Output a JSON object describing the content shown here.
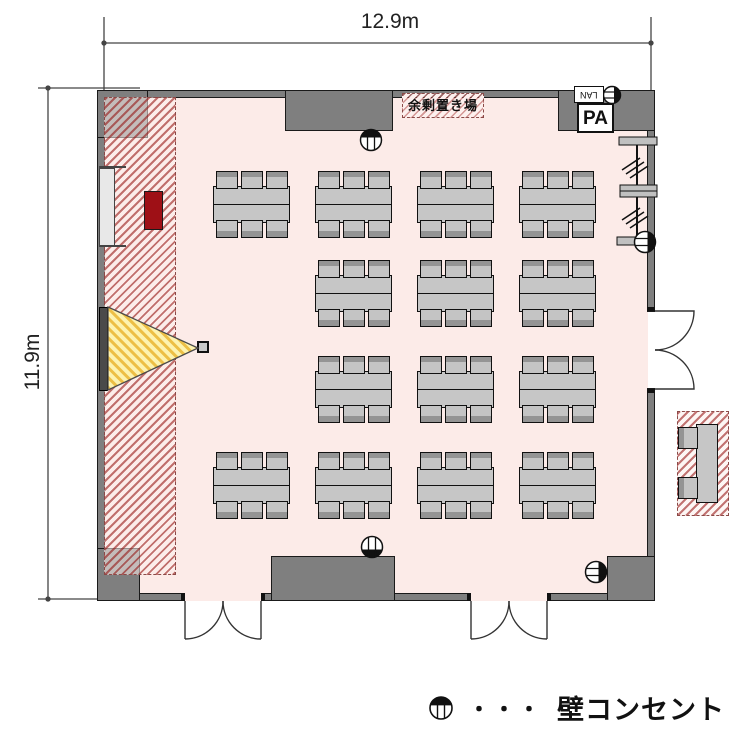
{
  "title": "seminar-room-floor-plan",
  "dimensions": {
    "width": "12.9m",
    "height": "11.9m"
  },
  "stage": {
    "storage_label": "余剰置き場",
    "pa_label": "PA",
    "lan_label": "LAN"
  },
  "legend": {
    "symbol": "wall-outlet",
    "dots": "・・・",
    "label": "壁コンセント"
  },
  "furniture": {
    "table_count": 14,
    "chairs_per_table": 6,
    "grid_rows": 4,
    "grid_columns": 4,
    "reception_tables": 1,
    "reception_chairs": 2,
    "wall_outlet_count": 5,
    "door_count": 3
  },
  "colors": {
    "floor": "#fcebe8",
    "wall": "#7f7f7f",
    "hatch_red": "#b25250",
    "beam_yellow": "#edbf45",
    "equipment_red": "#9e1016",
    "table_gray": "#c6c6c6"
  }
}
